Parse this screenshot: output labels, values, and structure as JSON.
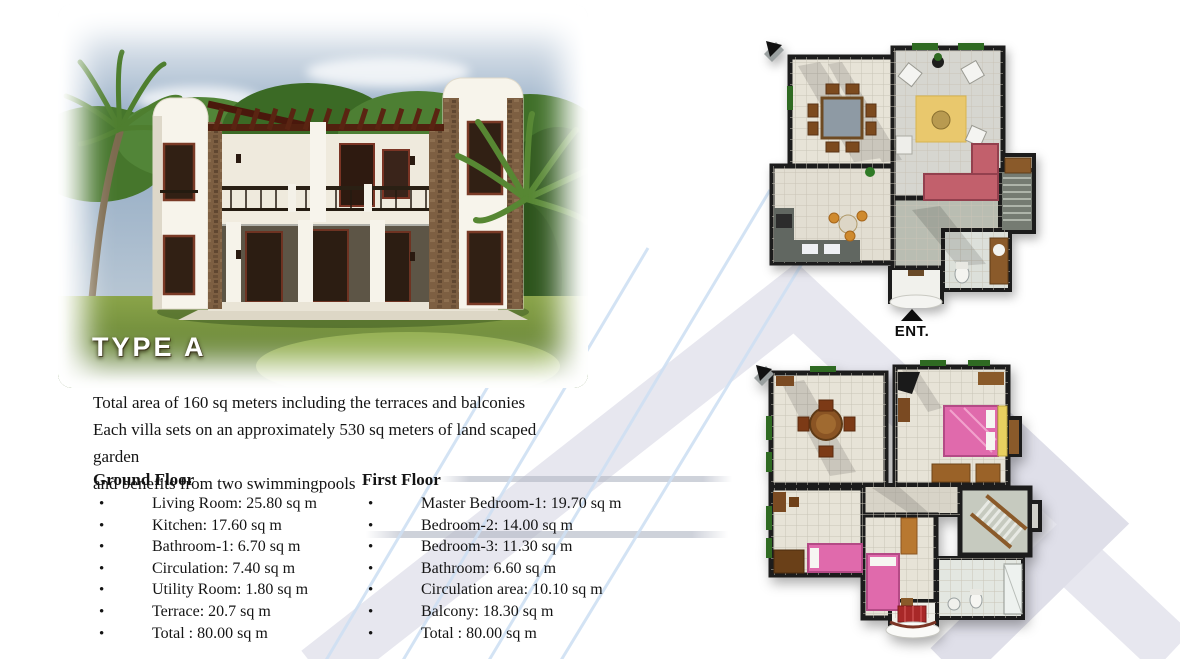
{
  "photo": {
    "type_label": "TYPE A"
  },
  "intro": {
    "lines": [
      "Total area of 160 sq meters including the terraces and balconies",
      "Each villa sets on an approximately 530 sq meters of land scaped garden",
      "and benefits from two swimmingpools"
    ]
  },
  "lists": {
    "ground": {
      "title": "Ground Floor",
      "items": [
        "Living Room: 25.80 sq m",
        "Kitchen: 17.60 sq m",
        "Bathroom-1: 6.70 sq m",
        "Circulation: 7.40 sq m",
        "Utility Room: 1.80 sq m",
        "Terrace: 20.7 sq m",
        "Total : 80.00 sq m"
      ]
    },
    "first": {
      "title": "First Floor",
      "items": [
        "Master Bedroom-1: 19.70 sq m",
        "Bedroom-2: 14.00 sq m",
        "Bedroom-3: 11.30 sq m",
        "Bathroom: 6.60 sq m",
        "Circulation area: 10.10 sq m",
        "Balcony: 18.30 sq m",
        "Total : 80.00 sq m"
      ]
    }
  },
  "plans": {
    "entrance_label": "ENT."
  },
  "colors": {
    "watermark_gray": "#e7e7ef",
    "watermark_blue": "#cfe0f3",
    "bed_pink": "#e06aac",
    "rug_yellow": "#e9c86d",
    "sofa_red": "#c2606c",
    "wall_dark": "#1c1c1c"
  }
}
